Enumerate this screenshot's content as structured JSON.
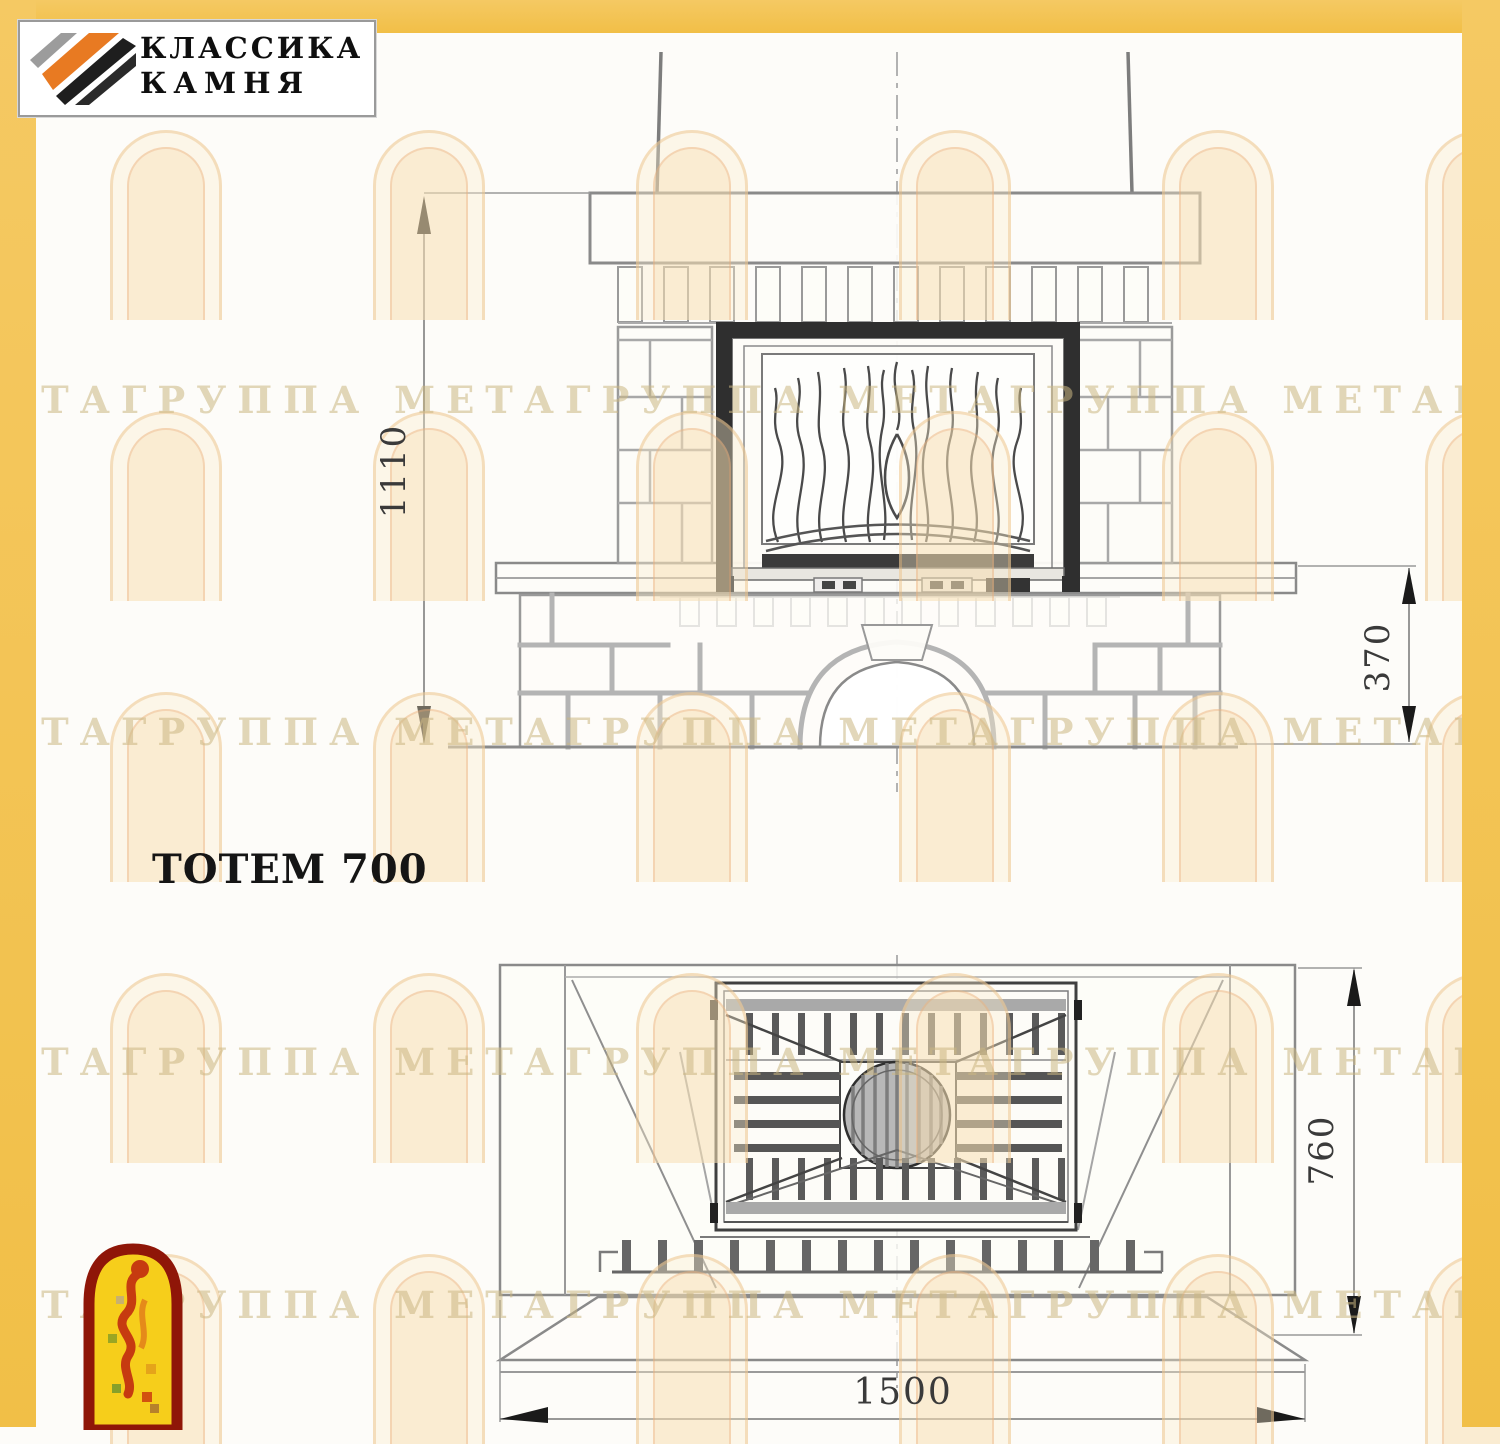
{
  "brand_logo": {
    "line1": "КЛАССИКА",
    "line2": "КАМНЯ"
  },
  "drawing": {
    "title": "ТОТЕМ 700"
  },
  "dimensions": {
    "front_total_height": "1110",
    "front_bench_height": "370",
    "plan_depth": "760",
    "plan_width": "1500"
  },
  "watermark": {
    "row_text": "МЕТАГРУППА МЕТАГРУППА МЕТАГРУППА МЕТАГРУППА"
  },
  "colors": {
    "frame_yellow": "#F2C350",
    "line_gray": "#8a8a8a",
    "dark_fill": "#2f2f2f",
    "logo_orange": "#E87A22",
    "emblem_red": "#8F1608",
    "emblem_yellow": "#F6CE1B"
  }
}
